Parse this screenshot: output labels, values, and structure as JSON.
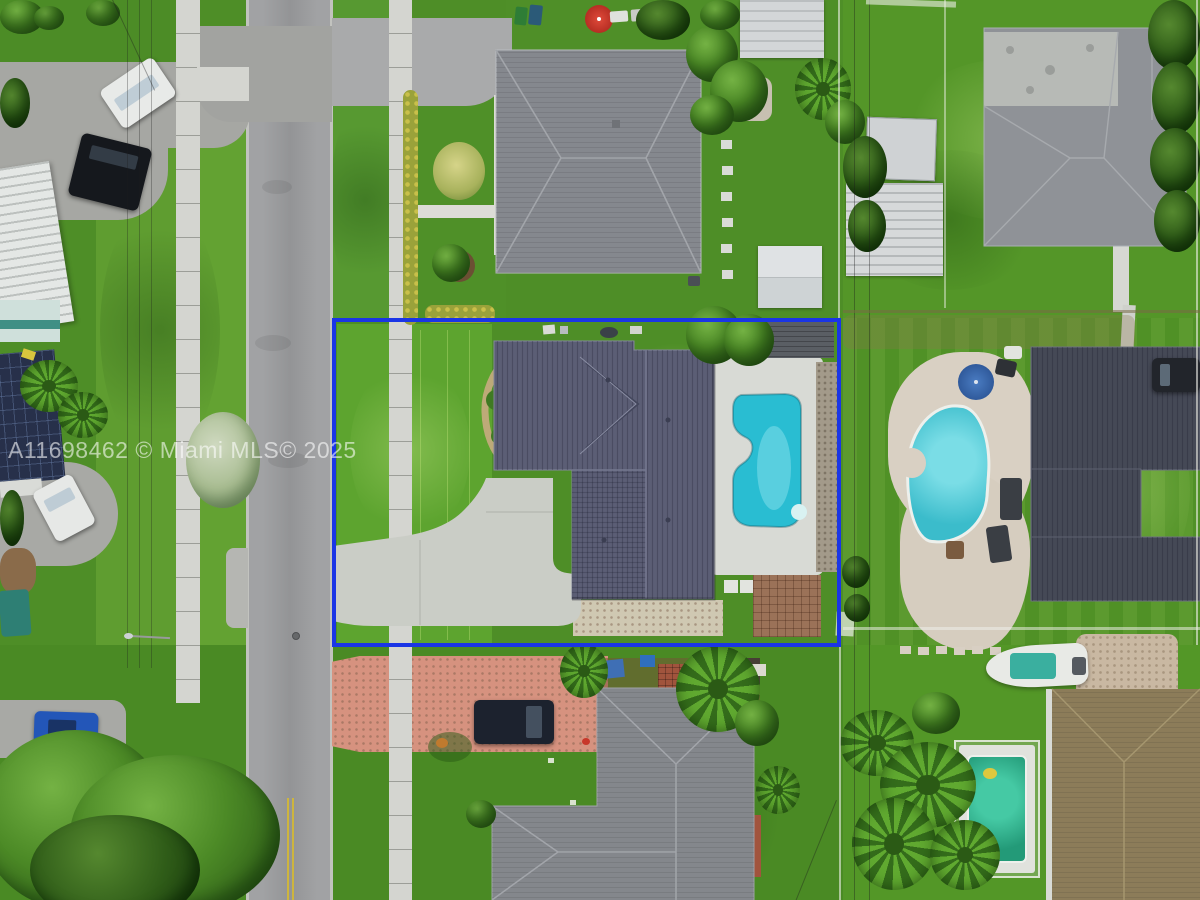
{
  "meta": {
    "description": "Aerial drone photograph of a suburban single-family home lot outlined in blue (real-estate MLS listing photo)"
  },
  "watermark": {
    "text": "A11698462 © Miami MLS© 2025",
    "color": "#ffffff",
    "opacity": 0.58
  },
  "boundary": {
    "label": "subject-property-outline",
    "color": "#1a35e6"
  },
  "palette": {
    "street_asphalt": "#9b9c9e",
    "parking_asphalt": "#a6a7a3",
    "sidewalk": "#d4d5d0",
    "driveway_concrete": "#cacdc6",
    "lawn_bright": "#5da42f",
    "lawn_dark": "#47861f",
    "subject_roof_slate": "#5b5e75",
    "top_neighbor_roof": "#85888e",
    "right_neighbor_roof": "#454956",
    "topright_neighbor_roof": "#8f9297",
    "bottom_neighbor_roof": "#84878c",
    "tan_roof": "#8c7c59",
    "pool_subject": "#29bdd2",
    "pool_top_neighbor": "#2cb4c8",
    "pool_kidney": "#3bbccb",
    "pool_green": "#2aa385",
    "brick_driveway": "#d6927f",
    "paver_patio_tan": "#d9d0c3",
    "boundary_blue": "#1a35e6"
  },
  "features": [
    "subject-property-outline",
    "subject-house-metal-roof",
    "subject-pool",
    "subject-pool-deck",
    "subject-driveway",
    "subject-brick-patio",
    "subject-rear-wood-deck",
    "public-sidewalk",
    "residential-street",
    "street-center-line",
    "manhole-cover",
    "top-neighbor-house",
    "top-neighbor-pool",
    "right-neighbor-house",
    "right-neighbor-kidney-pool",
    "right-neighbor-paver-patio",
    "topright-neighbor-house",
    "bottom-neighbor-house",
    "bottom-right-neighbor-house",
    "bottom-right-neighbor-pool",
    "brick-paver-driveway",
    "mobile-home-roofs",
    "storage-sheds",
    "parked-white-car",
    "parked-black-suv",
    "parked-blue-car",
    "parked-dark-suv",
    "boat",
    "palm-trees",
    "shade-trees",
    "power-lines",
    "street-light",
    "mls-watermark",
    "red-umbrella",
    "blue-umbrella",
    "fire-pit",
    "junk-pile"
  ]
}
